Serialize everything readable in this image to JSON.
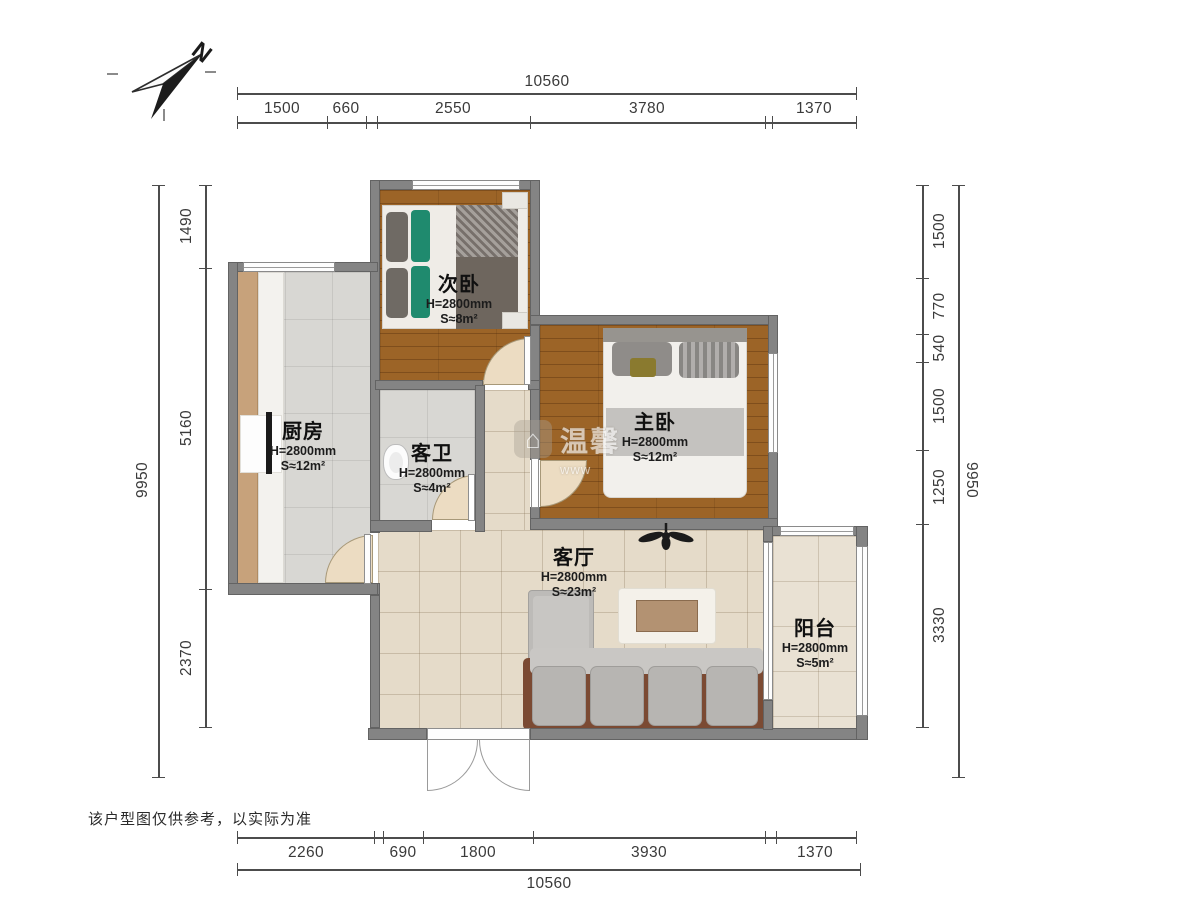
{
  "compass": {
    "label": "N"
  },
  "disclaimer": "该户型图仅供参考，以实际为准",
  "watermark": {
    "icon": "house-icon",
    "text": "温馨",
    "sub": "www"
  },
  "colors": {
    "wall": "#848484",
    "wood_floor": "#9c6427",
    "gray_tile": "#d8d7d3",
    "beige_tile": "#e5dbc9",
    "pillow_green": "#1f8a6e",
    "sofa_frame_brown": "#7b4a33"
  },
  "rooms": {
    "second_bedroom": {
      "name": "次卧",
      "height": "H=2800mm",
      "area": "S≈8m²"
    },
    "master_bedroom": {
      "name": "主卧",
      "height": "H=2800mm",
      "area": "S≈12m²"
    },
    "kitchen": {
      "name": "厨房",
      "height": "H=2800mm",
      "area": "S≈12m²"
    },
    "guest_bathroom": {
      "name": "客卫",
      "height": "H=2800mm",
      "area": "S≈4m²"
    },
    "living_room": {
      "name": "客厅",
      "height": "H=2800mm",
      "area": "S≈23m²"
    },
    "balcony": {
      "name": "阳台",
      "height": "H=2800mm",
      "area": "S≈5m²"
    }
  },
  "dimensions": {
    "top": {
      "total": "10560",
      "segments": [
        "1500",
        "660",
        "2550",
        "3780",
        "1370"
      ]
    },
    "bottom": {
      "total": "10560",
      "segments": [
        "2260",
        "690",
        "1800",
        "3930",
        "1370"
      ]
    },
    "left": {
      "total": "9950",
      "segments": [
        "1490",
        "5160",
        "2370"
      ]
    },
    "right": {
      "total": "9950",
      "segments": [
        "1500",
        "770",
        "540",
        "1500",
        "1250",
        "3330"
      ]
    }
  }
}
